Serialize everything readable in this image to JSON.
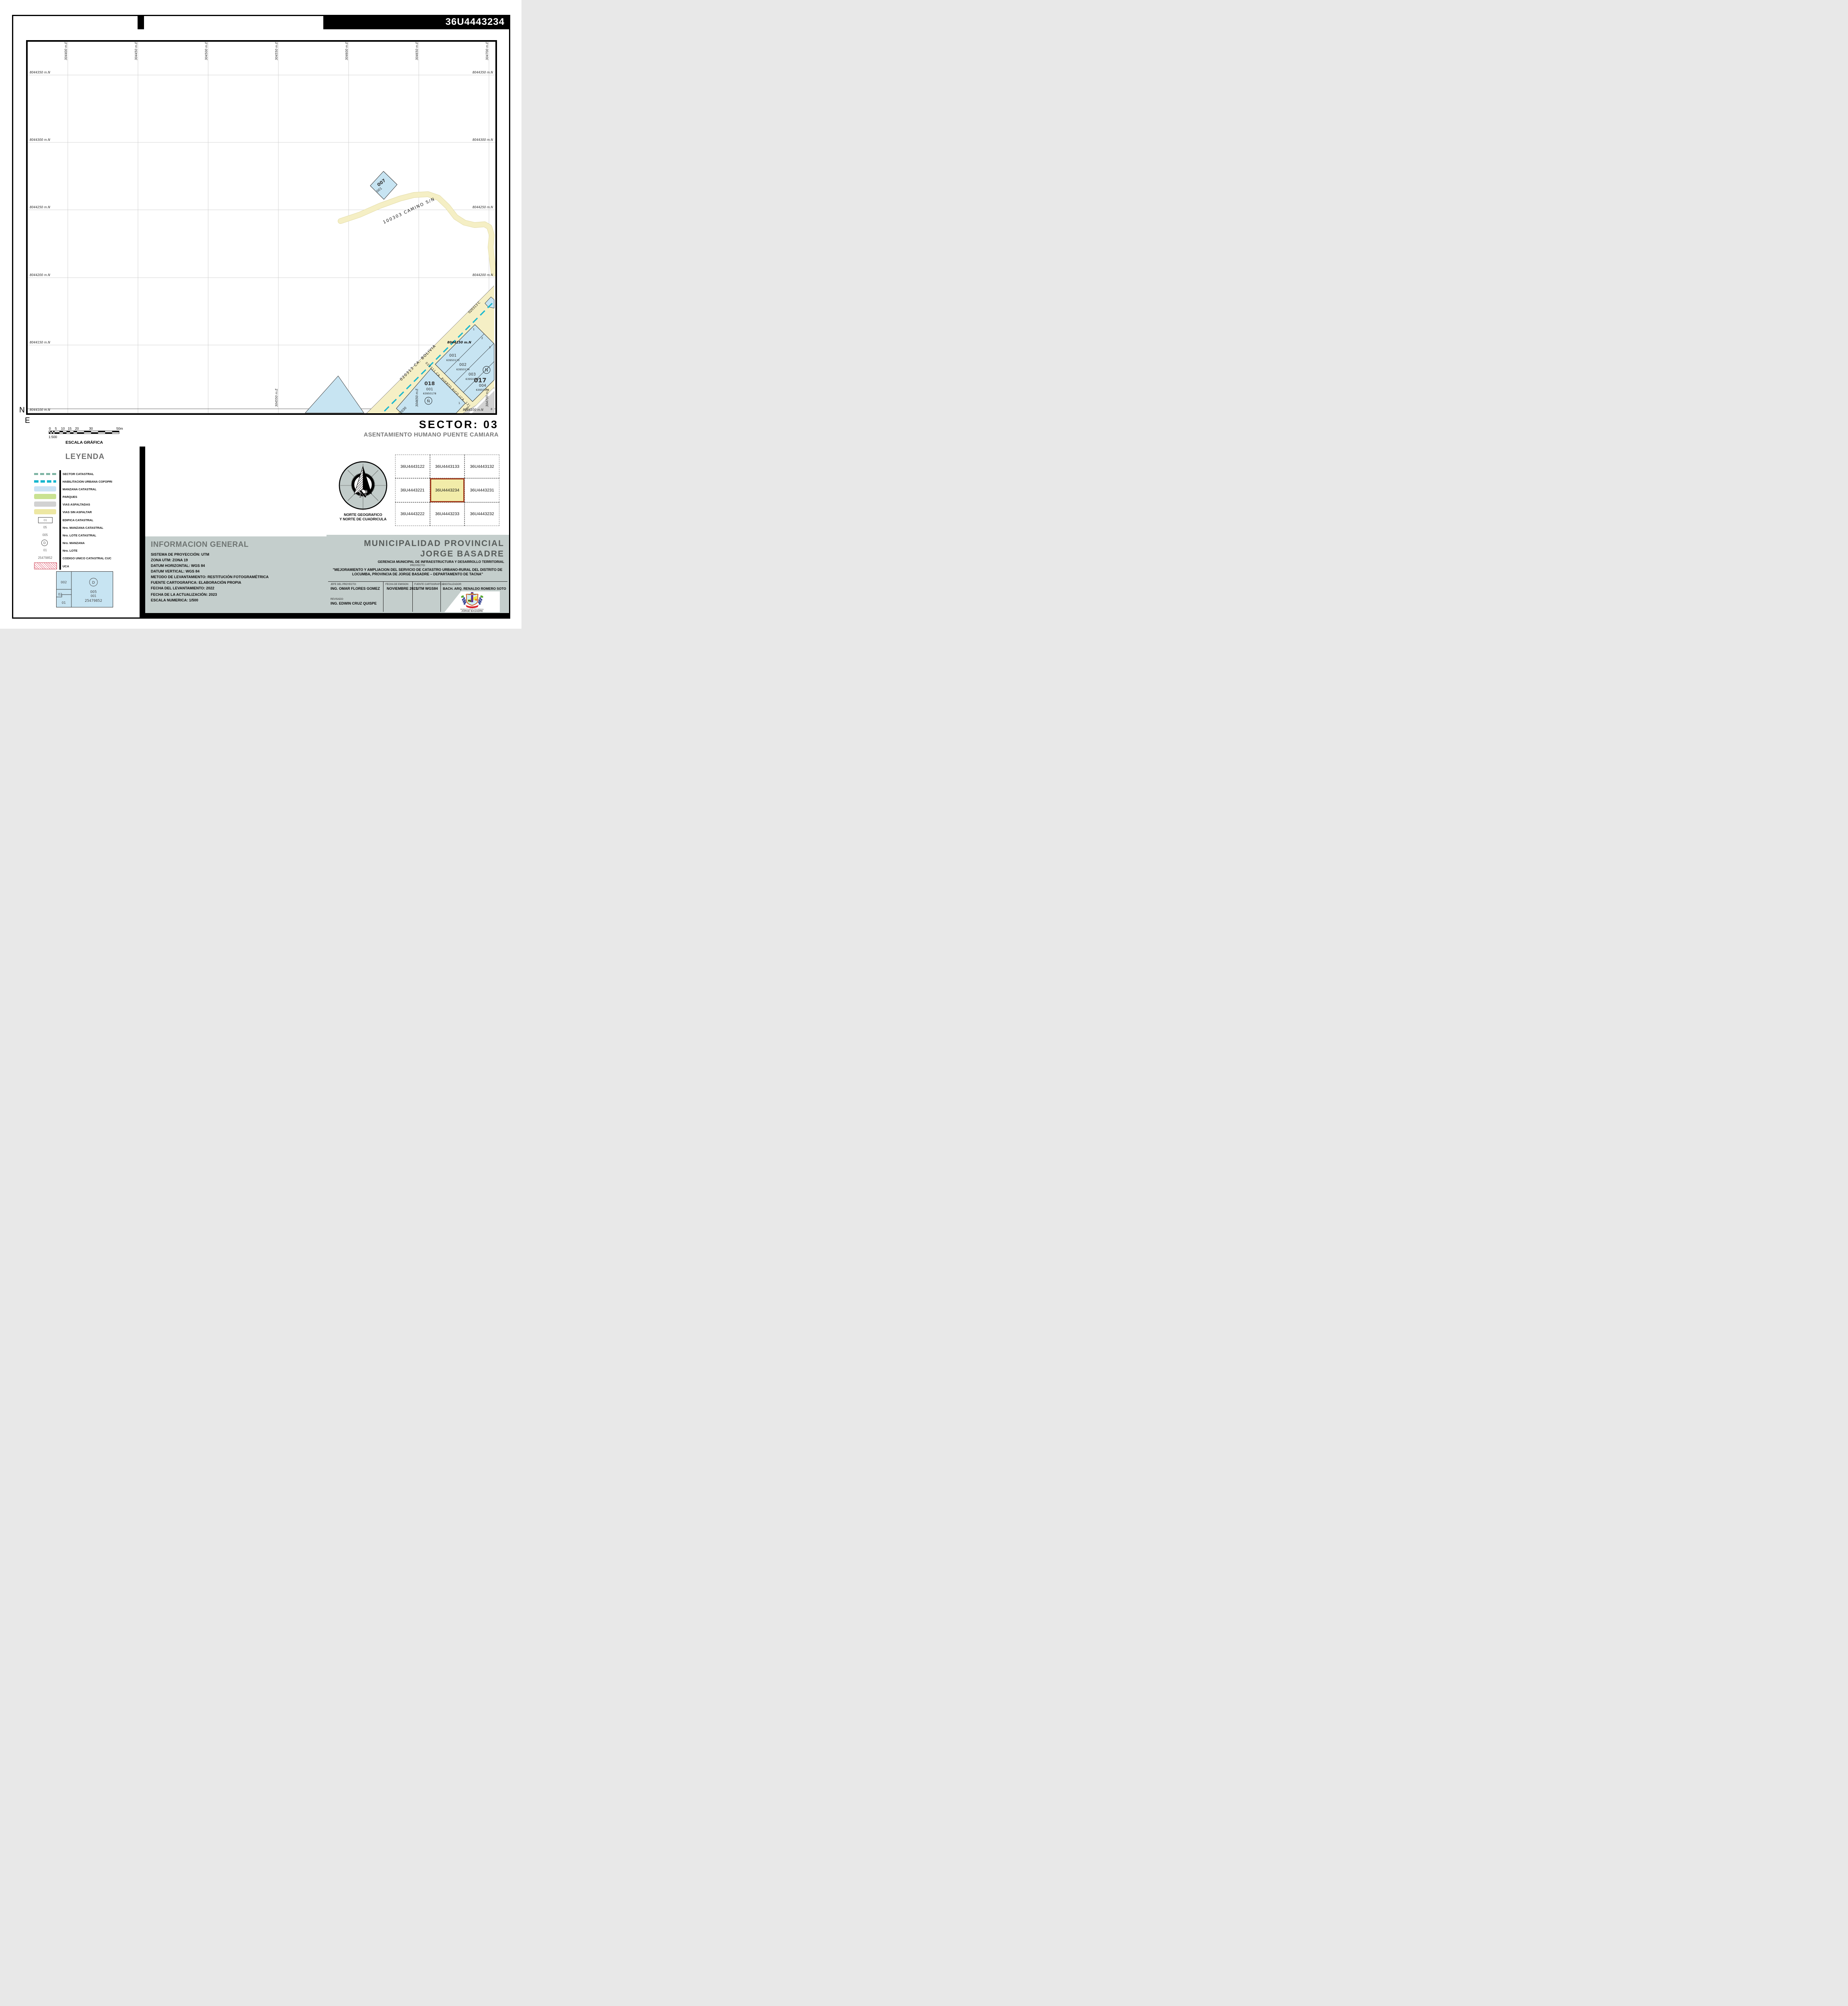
{
  "sheet": {
    "code": "36U4443234",
    "sector_title": "SECTOR:   03",
    "settlement": "ASENTAMIENTO HUMANO PUENTE CAMIARA"
  },
  "map": {
    "axis_n": "N",
    "axis_e": "E",
    "easting_labels": [
      "304400  m.E",
      "304450  m.E",
      "304500  m.E",
      "304550  m.E",
      "304600  m.E",
      "304650  m.E",
      "304700  m.E"
    ],
    "northing_labels": [
      "8044350  m.N",
      "8044300  m.N",
      "8044250  m.N",
      "8044200  m.N",
      "8044150  m.N",
      "8044100  m.N"
    ],
    "camino_label": "100303  CAMINO  S/N",
    "bolivia_label": "020313  CA.  BOLIVIA",
    "bolivia_fragment": "020313  C",
    "puerto_rico_label": "020311  CA. PUERTO RICO  (CA. 12)",
    "bottom_left_fragment": "02030",
    "ama_fragment": "AMA",
    "corner_8": "8",
    "block_007": {
      "id": "007",
      "lot": "001"
    },
    "block_017": {
      "id": "017",
      "north_mark": "N",
      "corner_numbers": [
        "1",
        "2",
        "3"
      ],
      "lots": [
        {
          "n": "001",
          "cuc": "63950173"
        },
        {
          "n": "002",
          "cuc": "63950174"
        },
        {
          "n": "003",
          "cuc": "63950175"
        },
        {
          "n": "004",
          "cuc": "63950176"
        }
      ]
    },
    "block_018": {
      "id": "018",
      "lot": "001",
      "cuc": "63950178",
      "mark": "Ñ",
      "corner_number": "1"
    }
  },
  "scalebar": {
    "ticks": [
      "0",
      "5",
      "10",
      "15",
      "20",
      "30",
      "50m"
    ],
    "ratio": "1:500",
    "title": "ESCALA GRÁFICA"
  },
  "legend": {
    "title": "LEYENDA",
    "items": [
      {
        "label": "SECTOR CATASTRAL"
      },
      {
        "label": "HABILITACION URBANA COFOPRI"
      },
      {
        "label": "MANZANA CATASTRAL"
      },
      {
        "label": "PARQUES"
      },
      {
        "label": "VIAS ASFALTADAS"
      },
      {
        "label": "VIAS SIN ASFALTAR"
      },
      {
        "label": "EDIFICA CATASTRAL",
        "swatch_text": "01"
      },
      {
        "label": "Nro.  MANZANA CATASTRAL",
        "swatch_text": "05"
      },
      {
        "label": "Nro.  LOTE  CATASTRAL",
        "swatch_text": "005"
      },
      {
        "label": "Nro.  MANZANA",
        "swatch_text": "D"
      },
      {
        "label": "Nro.  LOTE",
        "swatch_text": "01"
      },
      {
        "label": "CODIGO UNICO CATASTRAL CUC",
        "swatch_text": "25479852"
      },
      {
        "label": "UCA"
      }
    ],
    "example": {
      "manzana_cat": "002",
      "manzana": "02",
      "lote": "01",
      "circle": "D",
      "lote_cat": "005",
      "lote2": "001",
      "cuc": "25479852"
    }
  },
  "north": {
    "letter": "N",
    "caption1": "NORTE GEOGRAFICO",
    "caption2": "Y NORTE DE CUADRICULA"
  },
  "index_grid": {
    "cells": [
      [
        "36U4443122",
        "36U4443133",
        "36U4443132"
      ],
      [
        "36U4443221",
        "36U4443234",
        "36U4443231"
      ],
      [
        "36U4443222",
        "36U4443233",
        "36U4443232"
      ]
    ],
    "active": "36U4443234"
  },
  "info": {
    "title": "INFORMACION GENERAL",
    "lines": [
      "SISTEMA DE PROYECCIÓN: UTM",
      "ZONA UTM: ZONA 19",
      "DATUM HORIZONTAL: WGS 84",
      "DATUM VERTICAL: WGS 84",
      "METODO DE LEVANTAMIENTO: RESTITUCIÓN FOTOGRAMÉTRICA",
      "FUENTE CARTOGRAFICA: ELABORACIÓN PROPIA",
      "FECHA DEL LEVANTAMIENTO: 2022",
      "FECHA DE LA ACTUALIZACIÓN: 2023",
      "ESCALA NUMERICA: 1/500"
    ]
  },
  "muni": {
    "title1": "MUNICIPALIDAD PROVINCIAL",
    "title2": "JORGE BASADRE",
    "subtitle": "GERENCIA MUNICIPAL DE INFRAESTRUCTURA Y DESARROLLO TERRITORIAL",
    "proyecto_label": "PROYECTO:",
    "proyecto": "\"MEJORAMIENTO Y AMPLIACION DEL SERVICIO DE CATASTRO URBANO-RURAL DEL DISTRITO DE LOCUMBA, PROVINCIA DE JORGE BASADRE – DEPARTAMENTO DE TACNA\"",
    "f1_label": "JEFE DEL PROYECTO:",
    "f1_value": "ING. OMAR FLORES GOMEZ",
    "f1_label2": "REVISADO:",
    "f1_value2": "ING. EDWIN CRUZ QUISPE",
    "f2_label": "FECHA DE EMISION",
    "f2_value": "NOVIEMBRE 2023",
    "f3_label": "FUENTE CARTOGRAFICA:",
    "f3_value": "UTM WGS84",
    "f4_label": "DIGITALIZADOR:",
    "f4_value": "BACH. ARQ. RENALDO ROMERO SOTO",
    "logo_line1": "MUNICIPALIDAD PROVINCIAL",
    "logo_line2": "JORGE BASADRE"
  },
  "colors": {
    "manzana_blue": "#c7e4f2",
    "parques_green": "#c9e292",
    "vias_asfaltadas_gray": "#d2d2d2",
    "vias_sin_asfaltar_yellow": "#ede7a3",
    "road_yellow": "#f5efc5",
    "cofopri_teal": "#17b7cf",
    "sector_dash_green": "#7eb4a4",
    "uca_red": "#e25a70",
    "panel_gray": "#c4cecc",
    "index_active_fill": "#f2eca9",
    "index_active_border": "#a23a1b"
  }
}
